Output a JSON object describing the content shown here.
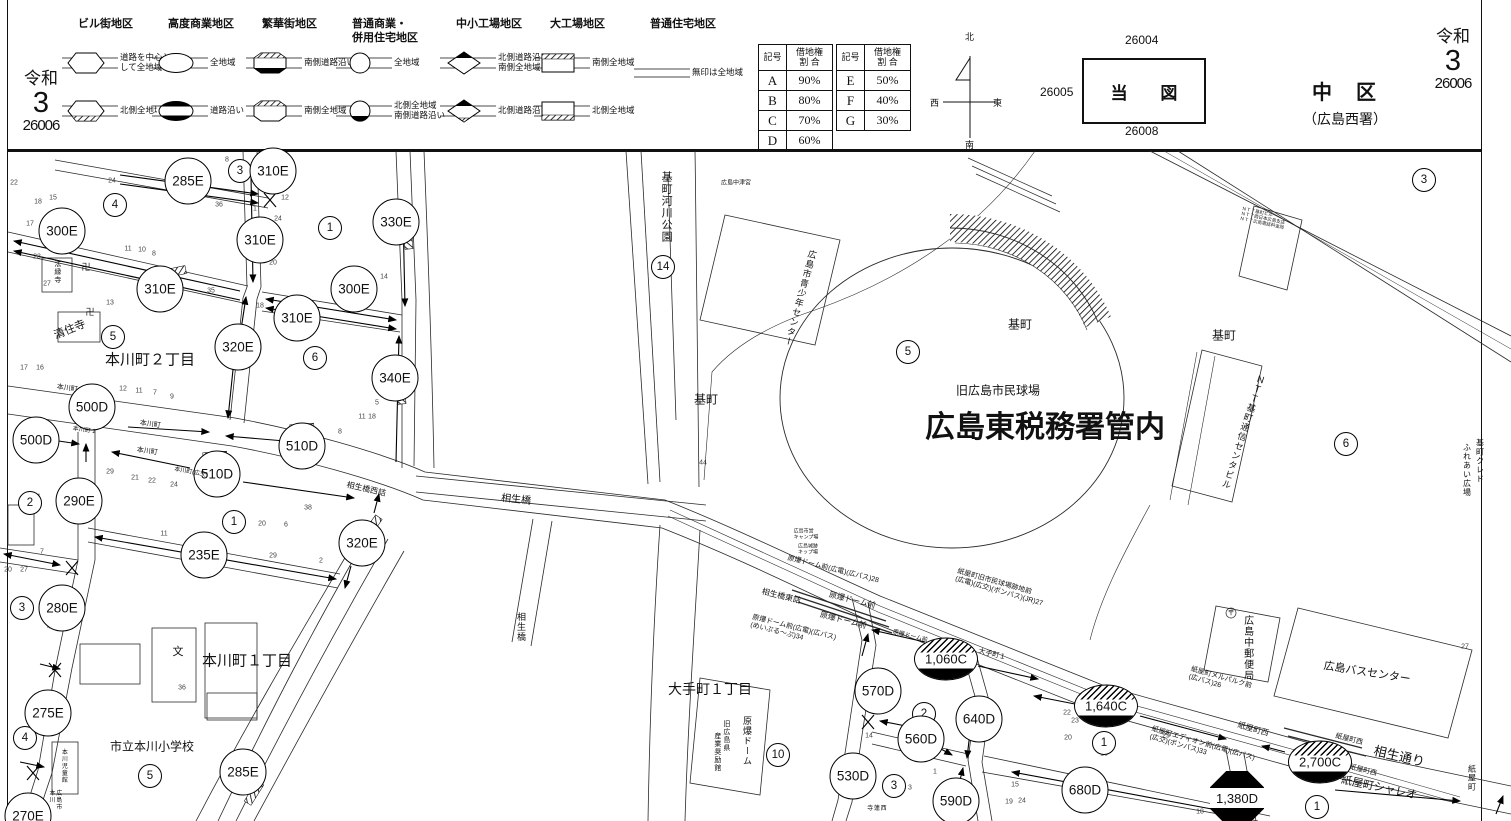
{
  "header": {
    "era_left": {
      "era": "令和",
      "year": "3",
      "num": "26006"
    },
    "era_right": {
      "era": "令和",
      "year": "3",
      "num": "26006"
    },
    "ward": {
      "name": "中　区",
      "office": "（広島西署）"
    },
    "legend": {
      "groups": [
        {
          "title": "ビル街地区",
          "x": 78,
          "items": [
            {
              "sym": "hex",
              "label": "道路を中心として全地域"
            },
            {
              "sym": "hexh",
              "label": "北側全地域"
            }
          ]
        },
        {
          "title": "高度商業地区",
          "x": 168,
          "items": [
            {
              "sym": "ell",
              "label": "全地域"
            },
            {
              "sym": "ellb",
              "label": "道路沿い"
            }
          ]
        },
        {
          "title": "繁華街地区",
          "x": 262,
          "items": [
            {
              "sym": "octb",
              "label": "南側道路沿い"
            },
            {
              "sym": "octh",
              "label": "南側全地域"
            }
          ]
        },
        {
          "title": "普通商業・\n併用住宅地区",
          "x": 352,
          "items": [
            {
              "sym": "cir",
              "label": "全地域"
            },
            {
              "sym": "cirb",
              "label": "北側全地域\n南側道路沿い"
            }
          ]
        },
        {
          "title": "中小工場地区",
          "x": 456,
          "items": [
            {
              "sym": "dia",
              "label": "北側道路沿い\n南側全地域"
            },
            {
              "sym": "diah",
              "label": "北側道路沿い"
            }
          ]
        },
        {
          "title": "大工場地区",
          "x": 550,
          "items": [
            {
              "sym": "rct",
              "label": "南側全地域"
            },
            {
              "sym": "rcb",
              "label": "北側全地域"
            }
          ]
        },
        {
          "title": "普通住宅地区",
          "x": 650,
          "items": [
            {
              "sym": "lin",
              "label": "無印は全地域"
            }
          ]
        }
      ]
    },
    "tables": [
      {
        "h1": "記号",
        "h2": "借地権\n割 合",
        "rows": [
          [
            "A",
            "90%"
          ],
          [
            "B",
            "80%"
          ],
          [
            "C",
            "70%"
          ],
          [
            "D",
            "60%"
          ]
        ]
      },
      {
        "h1": "記号",
        "h2": "借地権\n割 合",
        "rows": [
          [
            "E",
            "50%"
          ],
          [
            "F",
            "40%"
          ],
          [
            "G",
            "30%"
          ]
        ]
      }
    ],
    "compass": {
      "n": "北",
      "s": "南",
      "w": "西",
      "e": "東"
    },
    "index_map": {
      "title": "当 図",
      "top": "26004",
      "left": "26005",
      "bottom": "26008"
    }
  },
  "map": {
    "badges": [
      {
        "v": "285E",
        "x": 188,
        "y": 181,
        "t": "c"
      },
      {
        "v": "310E",
        "x": 273,
        "y": 171,
        "t": "c"
      },
      {
        "v": "300E",
        "x": 62,
        "y": 231,
        "t": "c"
      },
      {
        "v": "310E",
        "x": 260,
        "y": 240,
        "t": "c"
      },
      {
        "v": "330E",
        "x": 396,
        "y": 222,
        "t": "c"
      },
      {
        "v": "310E",
        "x": 160,
        "y": 289,
        "t": "c"
      },
      {
        "v": "300E",
        "x": 354,
        "y": 289,
        "t": "c"
      },
      {
        "v": "310E",
        "x": 297,
        "y": 318,
        "t": "c"
      },
      {
        "v": "320E",
        "x": 238,
        "y": 347,
        "t": "c"
      },
      {
        "v": "340E",
        "x": 395,
        "y": 378,
        "t": "c"
      },
      {
        "v": "500D",
        "x": 92,
        "y": 407,
        "t": "c"
      },
      {
        "v": "500D",
        "x": 36,
        "y": 440,
        "t": "c"
      },
      {
        "v": "510D",
        "x": 302,
        "y": 446,
        "t": "c"
      },
      {
        "v": "510D",
        "x": 217,
        "y": 474,
        "t": "c"
      },
      {
        "v": "290E",
        "x": 79,
        "y": 501,
        "t": "c"
      },
      {
        "v": "235E",
        "x": 204,
        "y": 555,
        "t": "c"
      },
      {
        "v": "320E",
        "x": 362,
        "y": 543,
        "t": "c"
      },
      {
        "v": "280E",
        "x": 62,
        "y": 608,
        "t": "c"
      },
      {
        "v": "275E",
        "x": 48,
        "y": 713,
        "t": "c"
      },
      {
        "v": "285E",
        "x": 243,
        "y": 772,
        "t": "c"
      },
      {
        "v": "270E",
        "x": 28,
        "y": 816,
        "t": "c"
      },
      {
        "v": "570D",
        "x": 878,
        "y": 691,
        "t": "c"
      },
      {
        "v": "530D",
        "x": 853,
        "y": 776,
        "t": "c"
      },
      {
        "v": "560D",
        "x": 921,
        "y": 739,
        "t": "c"
      },
      {
        "v": "590D",
        "x": 956,
        "y": 801,
        "t": "c"
      },
      {
        "v": "640D",
        "x": 979,
        "y": 719,
        "t": "c"
      },
      {
        "v": "680D",
        "x": 1085,
        "y": 790,
        "t": "c"
      },
      {
        "v": "1,060C",
        "x": 946,
        "y": 659,
        "t": "e"
      },
      {
        "v": "1,640C",
        "x": 1106,
        "y": 706,
        "t": "e"
      },
      {
        "v": "2,700C",
        "x": 1320,
        "y": 762,
        "t": "e"
      },
      {
        "v": "1,380D",
        "x": 1237,
        "y": 798,
        "t": "o"
      }
    ],
    "markers": [
      {
        "n": "3",
        "x": 240,
        "y": 171
      },
      {
        "n": "4",
        "x": 115,
        "y": 205
      },
      {
        "n": "1",
        "x": 330,
        "y": 228
      },
      {
        "n": "5",
        "x": 113,
        "y": 337
      },
      {
        "n": "6",
        "x": 315,
        "y": 358
      },
      {
        "n": "2",
        "x": 30,
        "y": 503
      },
      {
        "n": "1",
        "x": 234,
        "y": 522
      },
      {
        "n": "3",
        "x": 22,
        "y": 608
      },
      {
        "n": "4",
        "x": 25,
        "y": 738
      },
      {
        "n": "5",
        "x": 150,
        "y": 776
      },
      {
        "n": "14",
        "x": 663,
        "y": 267
      },
      {
        "n": "5",
        "x": 908,
        "y": 352
      },
      {
        "n": "3",
        "x": 1424,
        "y": 180
      },
      {
        "n": "6",
        "x": 1346,
        "y": 444
      },
      {
        "n": "10",
        "x": 778,
        "y": 755
      },
      {
        "n": "2",
        "x": 924,
        "y": 714
      },
      {
        "n": "3",
        "x": 894,
        "y": 786
      },
      {
        "n": "1",
        "x": 1104,
        "y": 743
      },
      {
        "n": "1",
        "x": 1317,
        "y": 807
      }
    ],
    "labels": [
      {
        "t": "本川町２丁目",
        "x": 150,
        "y": 361,
        "s": 15
      },
      {
        "t": "清住寺",
        "x": 70,
        "y": 330,
        "s": 11,
        "r": -22
      },
      {
        "t": "法縁寺",
        "x": 57,
        "y": 272,
        "s": 7,
        "v": 1
      },
      {
        "t": "卍",
        "x": 86,
        "y": 267,
        "s": 9
      },
      {
        "t": "卍",
        "x": 90,
        "y": 312,
        "s": 9
      },
      {
        "t": "本川町１丁目",
        "x": 247,
        "y": 662,
        "s": 15
      },
      {
        "t": "市立本川小学校",
        "x": 152,
        "y": 747,
        "s": 12
      },
      {
        "t": "文",
        "x": 178,
        "y": 652,
        "s": 11
      },
      {
        "t": "本川児童館",
        "x": 63,
        "y": 766,
        "s": 6,
        "v": 1
      },
      {
        "t": "広島市本川",
        "x": 54,
        "y": 800,
        "s": 6,
        "v": 1
      },
      {
        "t": "基町河川公園",
        "x": 666,
        "y": 207,
        "s": 11,
        "v": 1
      },
      {
        "t": "広島中津宮",
        "x": 736,
        "y": 184,
        "s": 6
      },
      {
        "t": "広島市青少年センター",
        "x": 800,
        "y": 298,
        "s": 9,
        "v": 1,
        "r": 15
      },
      {
        "t": "基町",
        "x": 706,
        "y": 400,
        "s": 12
      },
      {
        "t": "基町",
        "x": 1020,
        "y": 325,
        "s": 12
      },
      {
        "t": "基町",
        "x": 1224,
        "y": 336,
        "s": 12
      },
      {
        "t": "旧広島市民球場",
        "x": 998,
        "y": 391,
        "s": 12
      },
      {
        "t": "広島東税務署管内",
        "x": 1045,
        "y": 428,
        "s": 30,
        "b": 1
      },
      {
        "t": "ＮＴＴ基町通信センタビル",
        "x": 1243,
        "y": 432,
        "s": 9,
        "v": 1,
        "r": 18
      },
      {
        "t": "基町クレド",
        "x": 1479,
        "y": 461,
        "s": 8,
        "v": 1
      },
      {
        "t": "ふれあい広場",
        "x": 1466,
        "y": 470,
        "s": 8,
        "v": 1
      },
      {
        "t": "広島中郵便局",
        "x": 1247,
        "y": 648,
        "s": 10,
        "v": 1
      },
      {
        "t": "広島バスセンター",
        "x": 1367,
        "y": 673,
        "s": 11,
        "r": 9
      },
      {
        "t": "大手町１丁目",
        "x": 710,
        "y": 690,
        "s": 14
      },
      {
        "t": "原爆ドーム",
        "x": 747,
        "y": 741,
        "s": 9,
        "v": 1
      },
      {
        "t": "旧広島県",
        "x": 726,
        "y": 736,
        "s": 7,
        "v": 1
      },
      {
        "t": "産業奨励館",
        "x": 717,
        "y": 752,
        "s": 7,
        "v": 1
      },
      {
        "t": "西蓮寺",
        "x": 875,
        "y": 810,
        "s": 6,
        "v": 1
      },
      {
        "t": "相生橋",
        "x": 516,
        "y": 500,
        "s": 10,
        "r": 6
      },
      {
        "t": "相生橋",
        "x": 521,
        "y": 627,
        "s": 9,
        "v": 1
      },
      {
        "t": "相生橋西詰",
        "x": 366,
        "y": 490,
        "s": 8,
        "r": 13
      },
      {
        "t": "相生橋東詰",
        "x": 781,
        "y": 597,
        "s": 8,
        "r": 14
      },
      {
        "t": "原爆ドーム前(広電)(広バス)28",
        "x": 833,
        "y": 570,
        "s": 7,
        "r": 14
      },
      {
        "t": "原爆ドーム前",
        "x": 852,
        "y": 601,
        "s": 8,
        "r": 14
      },
      {
        "t": "原爆ドーム前",
        "x": 843,
        "y": 621,
        "s": 8,
        "r": 14
      },
      {
        "t": "原爆ドーム前(広電)(広バス)\n(めいぷる〜ぷ)34",
        "x": 793,
        "y": 632,
        "s": 7,
        "r": 14
      },
      {
        "t": "原爆ドーム前",
        "x": 910,
        "y": 637,
        "s": 6,
        "r": 14
      },
      {
        "t": "紙屋町旧市民球場跡地前\n(広電)(広交)(ボンバス)(JR)27",
        "x": 1000,
        "y": 588,
        "s": 7,
        "r": 16
      },
      {
        "t": "大手町１",
        "x": 992,
        "y": 655,
        "s": 7,
        "r": 14
      },
      {
        "t": "紙屋町メルパルク前\n(広バス)26",
        "x": 1220,
        "y": 682,
        "s": 7,
        "r": 16
      },
      {
        "t": "紙屋町西",
        "x": 1253,
        "y": 730,
        "s": 8,
        "r": 16
      },
      {
        "t": "紙屋町エディオン前(広電)(広バス)\n(広交)(ボンバス)33",
        "x": 1202,
        "y": 748,
        "s": 7,
        "r": 16
      },
      {
        "t": "紙屋町西",
        "x": 1349,
        "y": 740,
        "s": 7,
        "r": 14
      },
      {
        "t": "紙屋町西",
        "x": 1363,
        "y": 771,
        "s": 7,
        "r": 14
      },
      {
        "t": "相生通り",
        "x": 1399,
        "y": 757,
        "s": 13,
        "r": 13
      },
      {
        "t": "紙屋町シャレオ",
        "x": 1379,
        "y": 788,
        "s": 11,
        "r": 12
      },
      {
        "t": "紙屋町",
        "x": 1471,
        "y": 778,
        "s": 8,
        "v": 1
      },
      {
        "t": "本川町",
        "x": 67,
        "y": 389,
        "s": 7,
        "r": 8
      },
      {
        "t": "本川町",
        "x": 150,
        "y": 425,
        "s": 7,
        "r": 8
      },
      {
        "t": "本川町",
        "x": 147,
        "y": 452,
        "s": 7,
        "r": 8
      },
      {
        "t": "本川町(広交)",
        "x": 191,
        "y": 473,
        "s": 6,
        "r": 10
      },
      {
        "t": "本川町 1",
        "x": 84,
        "y": 431,
        "s": 6,
        "r": 8
      },
      {
        "t": "広島市営\nキャンプ場",
        "x": 806,
        "y": 535,
        "s": 5
      },
      {
        "t": "広島城跡\nキップ場",
        "x": 808,
        "y": 550,
        "s": 5
      },
      {
        "t": "ＮＴＴ基町ビル\nＮＴＴ西日本広島支店\nＮＴＴ広島電話料金局",
        "x": 1263,
        "y": 218,
        "s": 4.5,
        "r": 12
      },
      {
        "t": "〒",
        "x": 1231,
        "y": 614,
        "s": 7
      }
    ],
    "parcels": [
      [
        14,
        183,
        "22"
      ],
      [
        112,
        181,
        "24"
      ],
      [
        227,
        160,
        "8"
      ],
      [
        38,
        202,
        "18"
      ],
      [
        53,
        198,
        "15"
      ],
      [
        219,
        205,
        "36"
      ],
      [
        255,
        209,
        "1"
      ],
      [
        285,
        198,
        "12"
      ],
      [
        30,
        224,
        "17"
      ],
      [
        278,
        219,
        "24"
      ],
      [
        37,
        257,
        "23"
      ],
      [
        128,
        249,
        "11"
      ],
      [
        142,
        250,
        "10"
      ],
      [
        154,
        254,
        "8"
      ],
      [
        273,
        263,
        "20"
      ],
      [
        211,
        291,
        "35"
      ],
      [
        47,
        284,
        "27"
      ],
      [
        110,
        303,
        "13"
      ],
      [
        260,
        306,
        "18"
      ],
      [
        384,
        277,
        "14"
      ],
      [
        24,
        368,
        "17"
      ],
      [
        40,
        368,
        "16"
      ],
      [
        123,
        389,
        "12"
      ],
      [
        139,
        391,
        "11"
      ],
      [
        155,
        393,
        "7"
      ],
      [
        172,
        397,
        "9"
      ],
      [
        377,
        403,
        "5"
      ],
      [
        362,
        417,
        "11"
      ],
      [
        372,
        417,
        "18"
      ],
      [
        340,
        432,
        "8"
      ],
      [
        46,
        455,
        "23"
      ],
      [
        37,
        497,
        "21"
      ],
      [
        110,
        472,
        "29"
      ],
      [
        135,
        478,
        "21"
      ],
      [
        152,
        481,
        "22"
      ],
      [
        174,
        485,
        "24"
      ],
      [
        164,
        534,
        "11"
      ],
      [
        308,
        508,
        "38"
      ],
      [
        262,
        524,
        "20"
      ],
      [
        286,
        525,
        "6"
      ],
      [
        273,
        556,
        "29"
      ],
      [
        321,
        561,
        "2"
      ],
      [
        8,
        570,
        "20"
      ],
      [
        24,
        570,
        "27"
      ],
      [
        42,
        552,
        "7"
      ],
      [
        49,
        627,
        "4"
      ],
      [
        182,
        688,
        "36"
      ],
      [
        703,
        463,
        "44"
      ],
      [
        869,
        736,
        "14"
      ],
      [
        1465,
        647,
        "27"
      ],
      [
        1067,
        713,
        "22"
      ],
      [
        1075,
        721,
        "23"
      ],
      [
        1068,
        738,
        "20"
      ],
      [
        1166,
        736,
        "29"
      ],
      [
        934,
        755,
        "1"
      ],
      [
        935,
        772,
        "1"
      ],
      [
        910,
        788,
        "3"
      ],
      [
        938,
        804,
        "4"
      ],
      [
        1015,
        785,
        "15"
      ],
      [
        1022,
        801,
        "24"
      ],
      [
        1009,
        802,
        "19"
      ],
      [
        1200,
        812,
        "18"
      ],
      [
        1104,
        754,
        "18"
      ]
    ]
  }
}
